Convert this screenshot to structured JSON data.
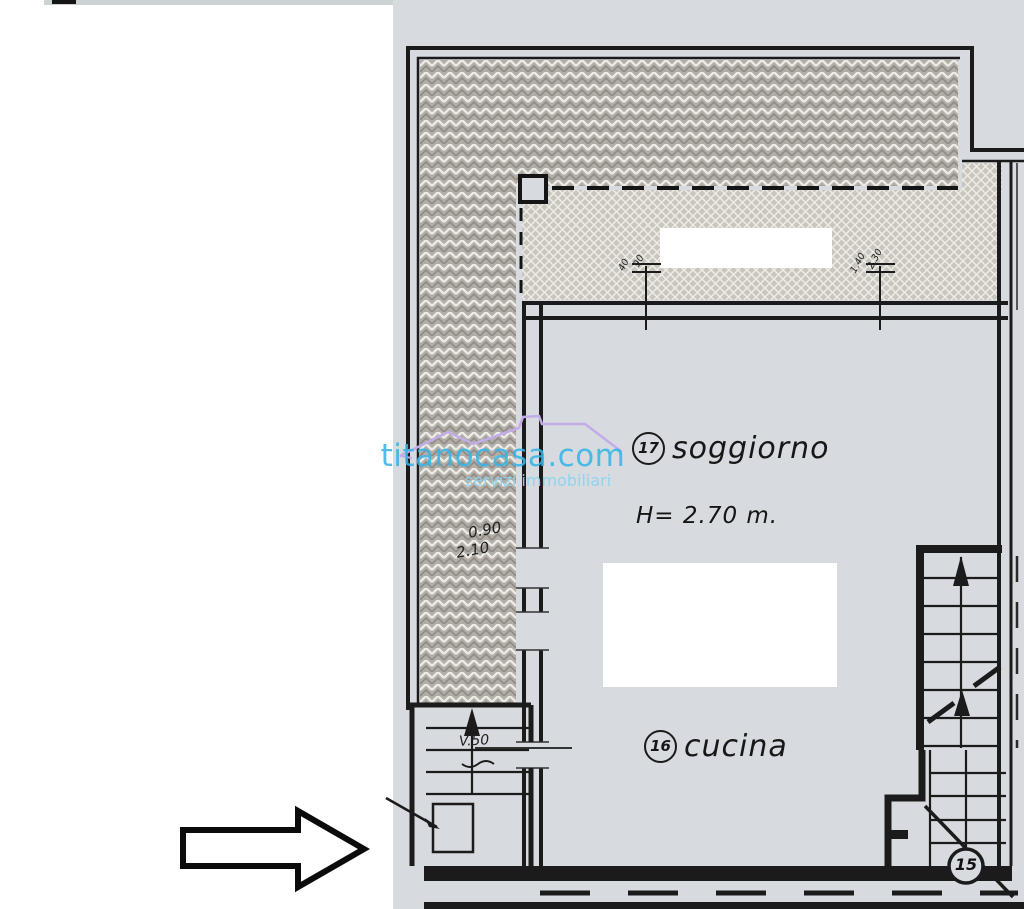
{
  "scan": {
    "watermark": {
      "brand": "titanocasa.com",
      "tagline": "servizi immobiliari",
      "brand_color": "#38b5e6",
      "tagline_color": "#8ed3ef",
      "roof_color": "#c3ace9"
    },
    "rooms": {
      "soggiorno": {
        "number": "17",
        "name": "soggiorno"
      },
      "cucina": {
        "number": "16",
        "name": "cucina"
      },
      "stair_room": {
        "number": "15"
      }
    },
    "annotations": {
      "ceiling_height": "H= 2.70 m.",
      "door_width": "0.90",
      "door_height": "2.10",
      "stair_note": "V.50",
      "window_left_dim1": "40",
      "window_left_dim2": "90",
      "window_right_dim1": "1.40",
      "window_right_dim2": "2.30"
    },
    "colors": {
      "paper": "#d7dbdf",
      "ink": "#1b1b1b",
      "hatch_dark": "#b2aea7",
      "hatch_light": "#c9c6bf"
    }
  }
}
